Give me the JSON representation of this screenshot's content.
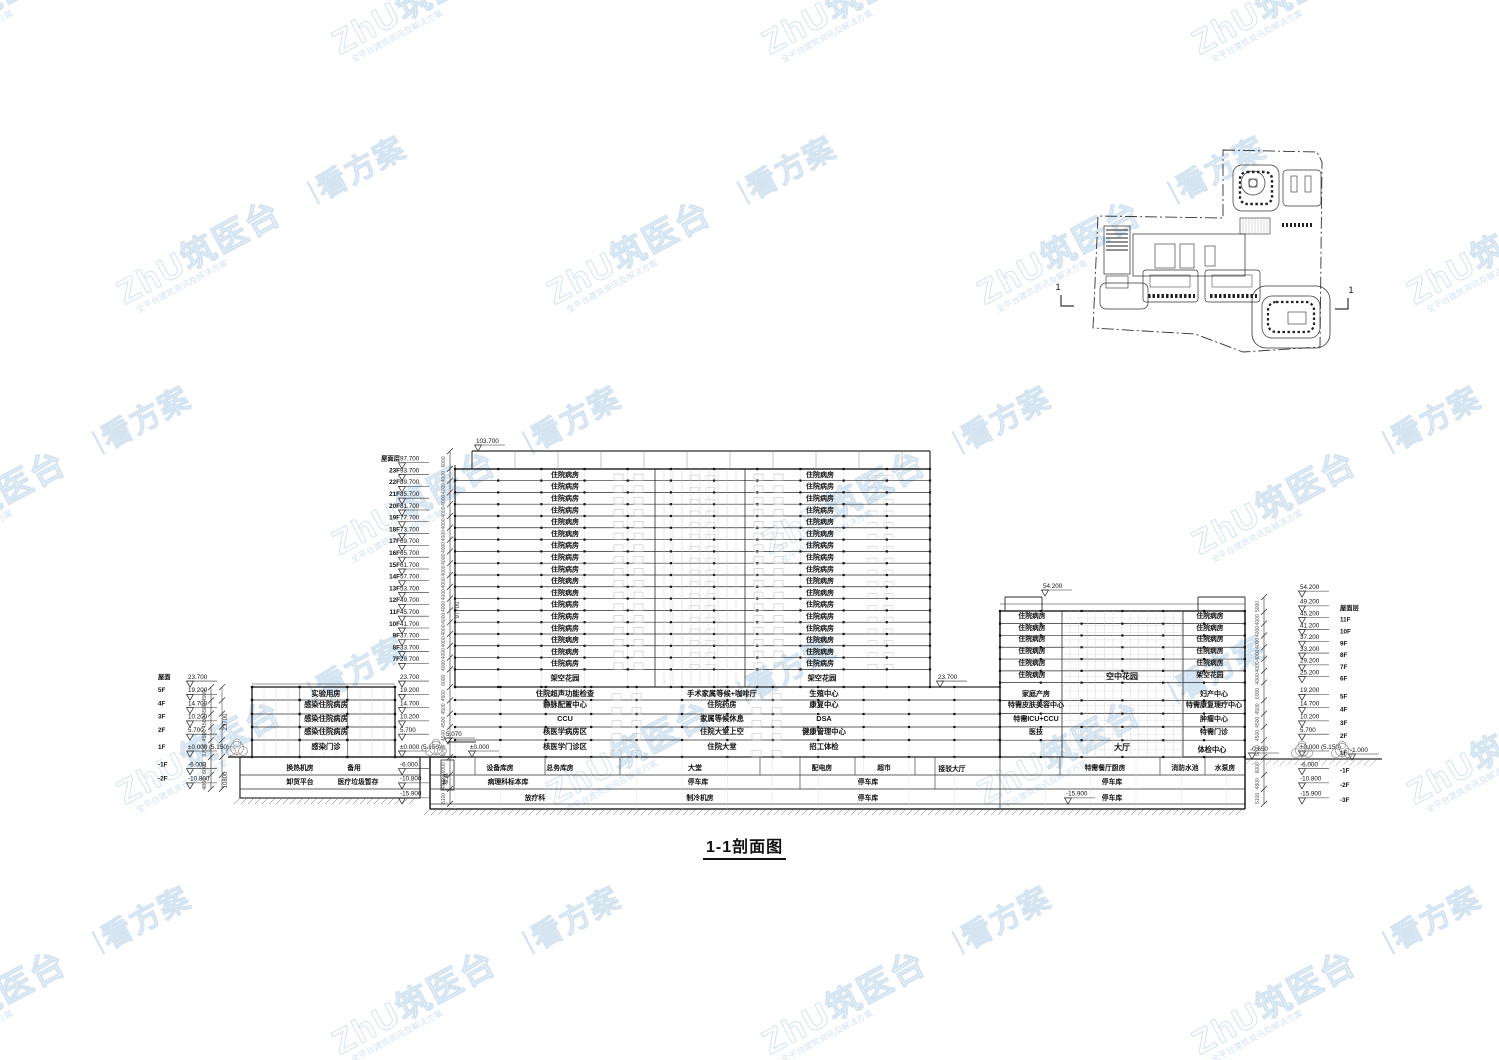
{
  "title": "1-1剖面图",
  "watermark": {
    "brand": "ZhU筑医台",
    "divider": "丨",
    "slogan": "看方案",
    "subtext": "全平台建筑资讯及解决方案",
    "color": "#9fc2e0"
  },
  "key_plan": {
    "section_label_left": "1",
    "section_label_right": "1"
  },
  "levels": {
    "left_outer": [
      {
        "floor": "屋面",
        "text": "23.700",
        "v": 23.7
      },
      {
        "floor": "5F",
        "text": "19.200",
        "v": 19.2
      },
      {
        "floor": "4F",
        "text": "14.700",
        "v": 14.7
      },
      {
        "floor": "3F",
        "text": "10.200",
        "v": 10.2
      },
      {
        "floor": "2F",
        "text": "5.700",
        "v": 5.7
      },
      {
        "floor": "1F",
        "text": "±0.000 (5.150)",
        "v": 0
      },
      {
        "floor": "-1F",
        "text": "-6.000",
        "v": -6
      },
      {
        "floor": "-2F",
        "text": "-10.800",
        "v": -10.8
      }
    ],
    "tower": [
      {
        "floor": "屋面层",
        "text": "97.700",
        "v": 97.7
      },
      {
        "floor": "23F",
        "text": "93.700",
        "v": 93.7
      },
      {
        "floor": "22F",
        "text": "89.700",
        "v": 89.7
      },
      {
        "floor": "21F",
        "text": "85.700",
        "v": 85.7
      },
      {
        "floor": "20F",
        "text": "81.700",
        "v": 81.7
      },
      {
        "floor": "19F",
        "text": "77.700",
        "v": 77.7
      },
      {
        "floor": "18F",
        "text": "73.700",
        "v": 73.7
      },
      {
        "floor": "17F",
        "text": "69.700",
        "v": 69.7
      },
      {
        "floor": "16F",
        "text": "65.700",
        "v": 65.7
      },
      {
        "floor": "15F",
        "text": "61.700",
        "v": 61.7
      },
      {
        "floor": "14F",
        "text": "57.700",
        "v": 57.7
      },
      {
        "floor": "13F",
        "text": "53.700",
        "v": 53.7
      },
      {
        "floor": "12F",
        "text": "49.700",
        "v": 49.7
      },
      {
        "floor": "11F",
        "text": "45.700",
        "v": 45.7
      },
      {
        "floor": "10F",
        "text": "41.700",
        "v": 41.7
      },
      {
        "floor": "9F",
        "text": "37.700",
        "v": 37.7
      },
      {
        "floor": "8F",
        "text": "33.700",
        "v": 33.7
      },
      {
        "floor": "7F",
        "text": "29.700",
        "v": 29.7
      }
    ],
    "mid": [
      {
        "text": "23.700",
        "v": 23.7
      },
      {
        "text": "19.200",
        "v": 19.2
      },
      {
        "text": "14.700",
        "v": 14.7
      },
      {
        "text": "10.200",
        "v": 10.2
      },
      {
        "text": "5.700",
        "v": 5.7
      },
      {
        "text": "±0.000 (5.150)",
        "v": 0
      },
      {
        "text": "-6.000",
        "v": -6
      },
      {
        "text": "-10.800",
        "v": -10.8
      },
      {
        "text": "-15.900",
        "v": -15.9
      }
    ],
    "right_outer": [
      {
        "floor": "",
        "text": "54.200",
        "v": 54.2
      },
      {
        "floor": "屋面层",
        "text": "49.200",
        "v": 49.2
      },
      {
        "floor": "11F",
        "text": "45.200",
        "v": 45.2
      },
      {
        "floor": "10F",
        "text": "41.200",
        "v": 41.2
      },
      {
        "floor": "9F",
        "text": "37.200",
        "v": 37.2
      },
      {
        "floor": "8F",
        "text": "33.200",
        "v": 33.2
      },
      {
        "floor": "7F",
        "text": "29.200",
        "v": 29.2
      },
      {
        "floor": "6F",
        "text": "25.200",
        "v": 25.2
      },
      {
        "floor": "5F",
        "text": "19.200",
        "v": 19.2
      },
      {
        "floor": "4F",
        "text": "14.700",
        "v": 14.7
      },
      {
        "floor": "3F",
        "text": "10.200",
        "v": 10.2
      },
      {
        "floor": "2F",
        "text": "5.700",
        "v": 5.7
      },
      {
        "floor": "1F",
        "text": "±0.000 (5.150)",
        "v": 0
      },
      {
        "floor": "-1F",
        "text": "-6.000",
        "v": -6
      },
      {
        "floor": "-2F",
        "text": "-10.800",
        "v": -10.8
      },
      {
        "floor": "-3F",
        "text": "-15.900",
        "v": -15.9
      }
    ],
    "misc": {
      "tower_top": "103.700",
      "right_top": "54.200",
      "podium_roof": "23.700",
      "entry": "5.070",
      "zero": "±0.000",
      "street_right": "-1.000",
      "dock_right": "-0.650",
      "pit": "-15.900"
    }
  },
  "dims": {
    "left_total": "23700",
    "left_basement": "10800",
    "tower_total": "97700"
  },
  "rooms": {
    "left_building": {
      "floors": [
        "实验用房",
        "感染住院病房",
        "感染住院病房",
        "感染住院病房",
        "感染门诊"
      ],
      "basement": [
        [
          "换热机房",
          "备用"
        ],
        [
          "卸货平台",
          "医疗垃圾暂存"
        ]
      ]
    },
    "main_tower": {
      "ward_label": "住院病房",
      "ward_floors": 17,
      "garden_left": "架空花园",
      "garden_right": "架空花园"
    },
    "podium": {
      "col1": [
        "住院超声功能检查",
        "静脉配置中心",
        "CCU",
        "核医学病房区",
        "核医学门诊区"
      ],
      "col2": [
        "手术家属等候+咖啡厅",
        "住院药房",
        "家属等候休息",
        "住院大堂上空",
        "住院大堂"
      ],
      "col3": [
        "生殖中心",
        "康复中心",
        "DSA",
        "健康管理中心",
        "招工体检"
      ]
    },
    "basement": {
      "b1": [
        "设备库房",
        "总务库房",
        "大堂",
        "配电房",
        "超市",
        "接驳大厅"
      ],
      "b2": [
        "病理科标本库",
        "停车库",
        "停车库"
      ],
      "b3": [
        "放疗科",
        "制冷机房",
        "停车库"
      ]
    },
    "right_tower": {
      "ward_label": "住院病房",
      "ward_floors_left": 6,
      "ward_floors_right": 5,
      "garden": "架空花园",
      "sky_garden": "空中花园",
      "col_left": [
        "家庭产房",
        "特需皮肤美容中心",
        "特需ICU+CCU",
        "医技"
      ],
      "col_right": [
        "妇产中心",
        "特需康复理疗中心",
        "肿瘤中心",
        "特需门诊"
      ],
      "f1": [
        "大厅",
        "体检中心"
      ],
      "b1": [
        "特需餐厅厨房",
        "消防水池",
        "水泵房"
      ],
      "b2": "停车库",
      "b3": "停车库"
    },
    "ramp": "坡道"
  }
}
